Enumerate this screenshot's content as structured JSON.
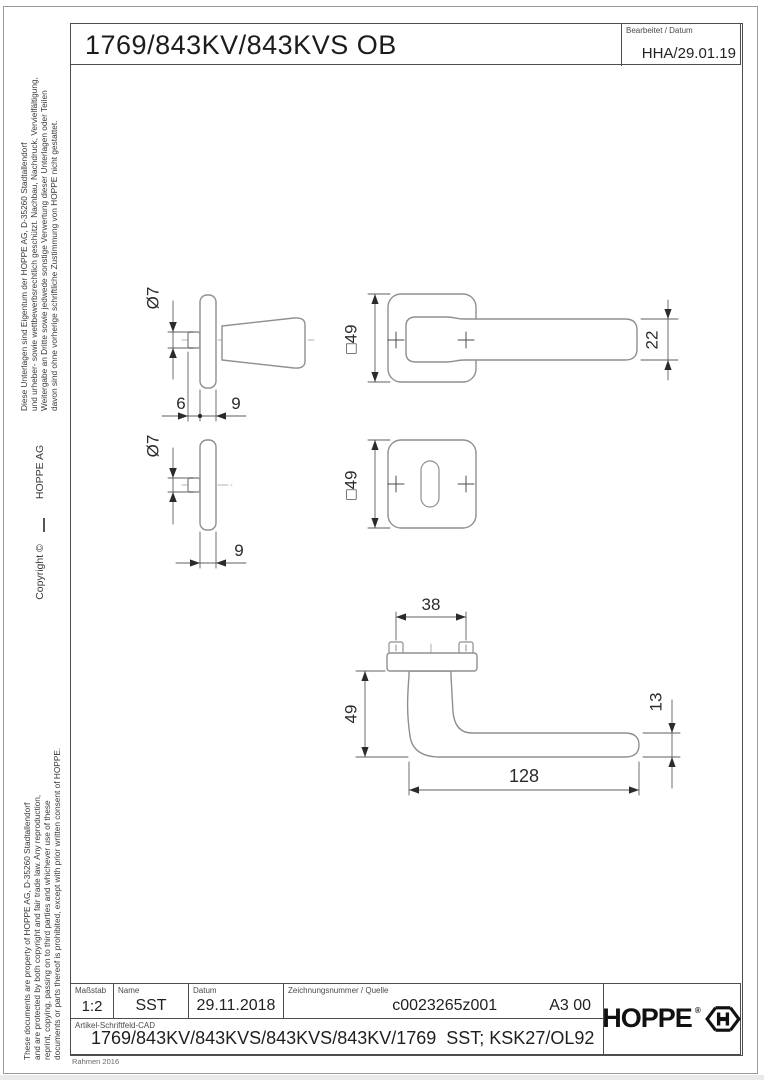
{
  "title_block_top": {
    "title": "1769/843KV/843KVS OB",
    "edited_label": "Bearbeitet / Datum",
    "edited_value": "HHA/29.01.19"
  },
  "sidebar": {
    "german_notice": "Diese Unterlagen sind Eigentum der  HOPPE AG, D-35260 Stadtallendorf\nund urheber- sowie wettbewerbsrechtlich geschützt. Nachbau, Nachdruck, Vervielfältigung,\nWeitergabe an Dritte sowie jedwede sonstige Verwertung dieser Unterlagen oder Teilen\ndavon sind ohne vorherige schriftliche Zustimmung von HOPPE nicht gestattet.",
    "copyright": "Copyright ©",
    "company": "HOPPE  AG",
    "english_notice": "These documents are property of HOPPE AG, D-35260 Stadtallendorf\nand are protected by both copyright and fair trade law. Any reproduction,\nreprint, copying, passing on to third parties and whichever use of these\ndocuments or parts thereof is prohibited, except with prior written consent of HOPPE."
  },
  "drawing": {
    "views": {
      "handle_side": {
        "diameter": "Ø7",
        "offset": "6",
        "rose_thickness": "9"
      },
      "handle_front": {
        "rose_size": "□49",
        "lever_width": "22"
      },
      "rose_side": {
        "diameter": "Ø7",
        "thickness": "9"
      },
      "rose_front": {
        "rose_size": "□49"
      },
      "handle_top": {
        "screw_spacing": "38",
        "height": "49",
        "grip_thickness": "13",
        "length": "128"
      }
    }
  },
  "title_block_bottom": {
    "scale_label": "Maßstab",
    "scale_value": "1:2",
    "name_label": "Name",
    "name_value": "SST",
    "date_label": "Datum",
    "date_value": "29.11.2018",
    "drawing_number_label": "Zeichnungsnummer / Quelle",
    "drawing_number_value": "c0023265z001",
    "format_value": "A3 00",
    "article_label": "Artikel-Schriftfeld-CAD",
    "article_value": "1769/843KV/843KVS/843KVS/843KV/1769  SST; KSK27/OL92",
    "logo_text": "HOPPE",
    "logo_reg": "®"
  },
  "footer": {
    "frame_note": "Rahmen 2016"
  }
}
